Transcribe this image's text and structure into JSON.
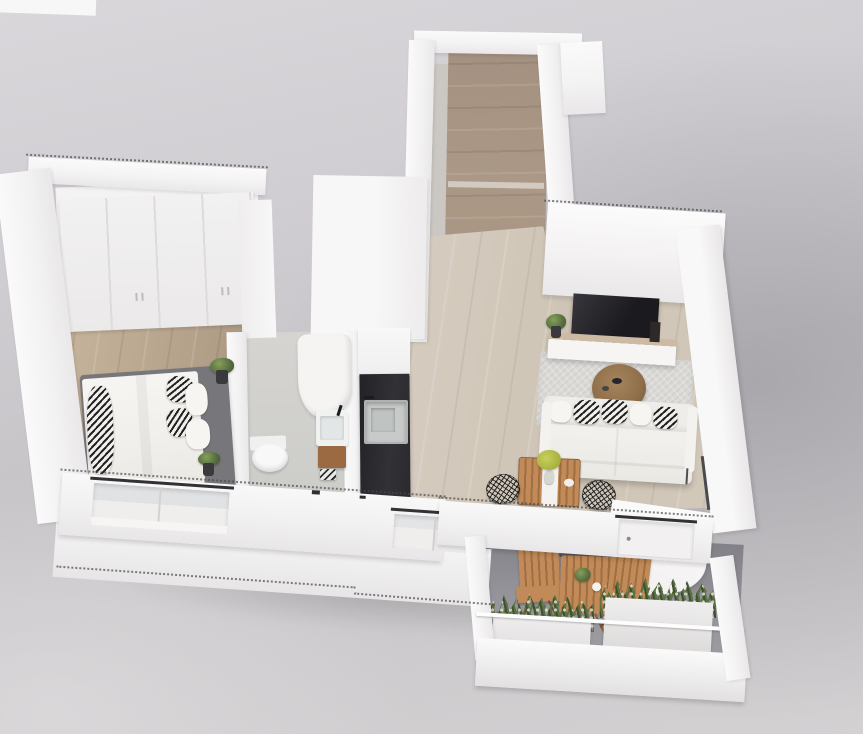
{
  "scene": {
    "title": "3D bird's-eye rendering of a one-bedroom apartment floor plan with balcony",
    "view": "axonometric top-down",
    "rooms": [
      {
        "id": "hallway",
        "label": "entry hallway",
        "features": [
          "wood-floor-corridor"
        ]
      },
      {
        "id": "bedroom",
        "label": "bedroom",
        "features": [
          "wardrobe",
          "double-bed",
          "patterned-pillows",
          "potted-plants",
          "window"
        ]
      },
      {
        "id": "bathroom",
        "label": "bathroom",
        "features": [
          "shower",
          "toilet",
          "vanity-sink",
          "wood-cabinet"
        ]
      },
      {
        "id": "kitchen",
        "label": "kitchen",
        "features": [
          "dark-galley-counter",
          "steel-sink",
          "white-cabinets"
        ]
      },
      {
        "id": "living-room",
        "label": "living room",
        "features": [
          "tv",
          "media-console",
          "area-rug",
          "round-coffee-table",
          "white-sofa",
          "dining-table",
          "two-wire-chairs",
          "flower-vase"
        ]
      },
      {
        "id": "balcony",
        "label": "balcony",
        "features": [
          "two-wooden-slat-chairs",
          "wooden-bistro-table",
          "planter-boxes",
          "white-railing",
          "white-curtain-panel"
        ]
      }
    ]
  },
  "palette": {
    "bg_top": "#dad7db",
    "bg_right": "#a6a3aa",
    "bg_bottom": "#d3d1d2",
    "wall": "#f7f6f6",
    "wall_shade": "#e9e7e9",
    "wood_bedroom": "#b7a48d",
    "wood_bedroom_l": "#c8b59d",
    "wood_bedroom_d": "#a7947d",
    "wood_hall": "#ab9886",
    "wood_living": "#cfc5b6",
    "bath_floor": "#d5d4d1",
    "counter": "#2b2a2e",
    "sink_steel": "#c7cac9",
    "tv": "#1b1b1f",
    "rug": "#dcdbd8",
    "sofa": "#f2f0ec",
    "pillow_ink": "#222222",
    "pillow_paper": "#f1efec",
    "bed_frame": "#77767a",
    "deck_wood": "#c18a58",
    "deck_wood_dark": "#a06f41",
    "table_wood": "#8f6f4a",
    "balcony_floor": "#94939a",
    "balcony_floor_dark": "#828188",
    "plant": "#5c7242",
    "plant_dark": "#3e512f",
    "flower": "#eae8db",
    "flower_yellow": "#c9d05c",
    "planter": "#dcdad9",
    "vanity_wood": "#9c6a42",
    "lintel": "#323234",
    "dots": "#4a4a4a",
    "frame_dark": "#4e4d51"
  }
}
